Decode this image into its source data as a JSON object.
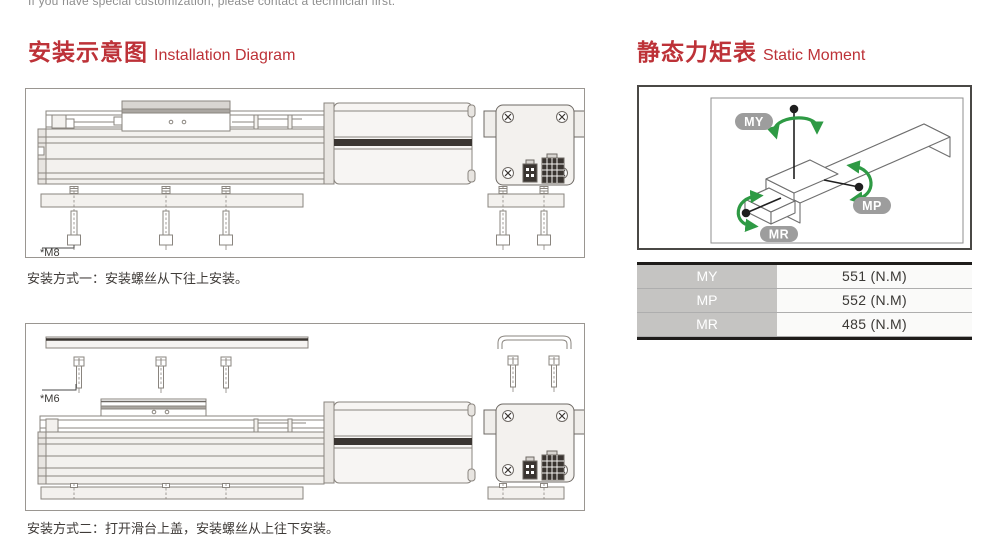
{
  "header": {
    "note": "If you have special customization, please contact a technician first."
  },
  "installation": {
    "title_zh": "安装示意图",
    "title_en": "Installation Diagram",
    "method1": {
      "screw_label": "*M8",
      "caption": "安装方式一：安装螺丝从下往上安装。"
    },
    "method2": {
      "screw_label": "*M6",
      "caption": "安装方式二：打开滑台上盖，安装螺丝从上往下安装。"
    }
  },
  "static_moment": {
    "title_zh": "静态力矩表",
    "title_en": "Static Moment",
    "diagram_labels": {
      "my": "MY",
      "mp": "MP",
      "mr": "MR"
    },
    "table_rows": [
      {
        "label": "MY",
        "value": "551 (N.M)"
      },
      {
        "label": "MP",
        "value": "552 (N.M)"
      },
      {
        "label": "MR",
        "value": "485 (N.M)"
      }
    ]
  },
  "colors": {
    "accent_red": "#bd3238",
    "arrow_green": "#2e9a44",
    "badge_gray": "#9d9d9d",
    "table_label_bg": "#c5c4c2",
    "table_bar": "#1e1c1a"
  }
}
